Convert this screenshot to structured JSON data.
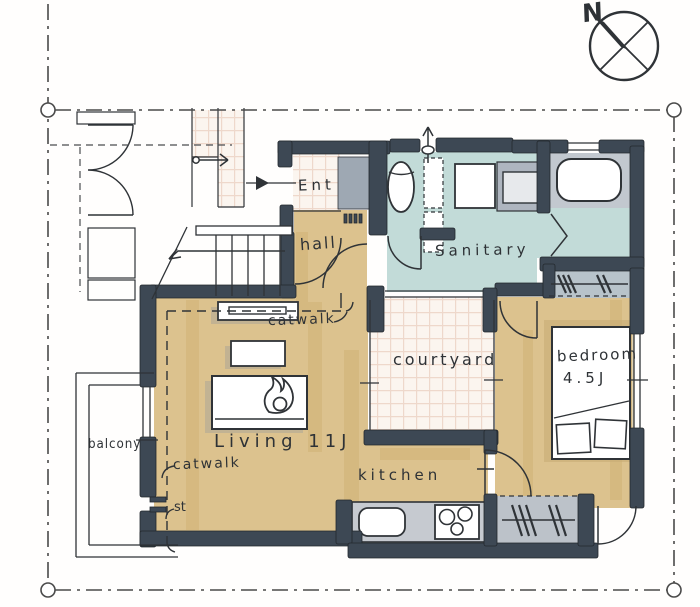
{
  "compass": {
    "north_label": "N"
  },
  "rooms": {
    "ent": {
      "label": "Ent"
    },
    "hall": {
      "label": "hall"
    },
    "sanitary": {
      "label": "Sanitary"
    },
    "courtyard": {
      "label": "courtyard"
    },
    "bedroom": {
      "label": "bedroom",
      "size": "4.5J"
    },
    "living": {
      "label": "Living 11J"
    },
    "kitchen": {
      "label": "kitchen"
    },
    "balcony": {
      "label": "balcony"
    }
  },
  "annotations": {
    "catwalk_upper": "catwalk",
    "catwalk_lower": "catwalk",
    "stove_abbr": "st"
  },
  "colors": {
    "wall": "#3d4854",
    "wood_floor": "#dcc28e",
    "wet_floor": "#c2dbd8",
    "tile_bg": "#fbf5ef",
    "tile_line": "#eed8cb",
    "fixture_gray": "#b9c0c8",
    "ink": "#2f3337"
  }
}
